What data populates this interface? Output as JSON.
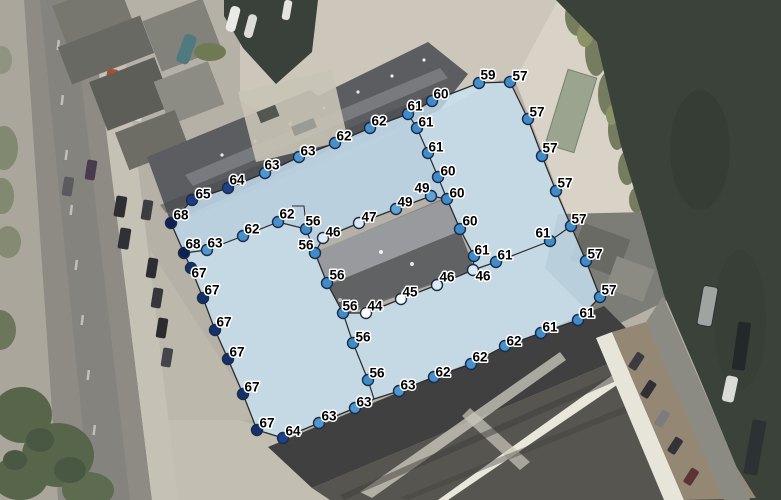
{
  "map_overlay": {
    "style": {
      "fill_color": "#c9e4f5",
      "fill_opacity": 0.8,
      "line_color": "#2b2b2e",
      "dot_radius": 5.5,
      "dot_stroke_color": "#1d2b45",
      "label_text_color": "#000000",
      "label_halo_color": "#ffffff"
    },
    "value_colors": {
      "44": "#ffffff",
      "45": "#f5fafd",
      "46": "#dbeaf6",
      "47": "#d8e8f5",
      "49": "#61a2d6",
      "56": "#3e8bca",
      "57": "#3e8bca",
      "59": "#4190cc",
      "60": "#3e8bca",
      "61": "#3f8ccb",
      "62": "#4690cc",
      "63": "#4e96cf",
      "64": "#1e4289",
      "65": "#1c3d7f",
      "67": "#15316c",
      "68": "#0d2157"
    },
    "outer_ring": [
      [
        171,
        223
      ],
      [
        192,
        200
      ],
      [
        228,
        188
      ],
      [
        265,
        173
      ],
      [
        299,
        157
      ],
      [
        335,
        143
      ],
      [
        370,
        128
      ],
      [
        408,
        114
      ],
      [
        432,
        101
      ],
      [
        479,
        83
      ],
      [
        510,
        82
      ],
      [
        528,
        119
      ],
      [
        542,
        156
      ],
      [
        556,
        191
      ],
      [
        571,
        226
      ],
      [
        586,
        261
      ],
      [
        600,
        297
      ],
      [
        578,
        320
      ],
      [
        541,
        333
      ],
      [
        505,
        346
      ],
      [
        471,
        364
      ],
      [
        434,
        377
      ],
      [
        399,
        391
      ],
      [
        374,
        399
      ],
      [
        355,
        408
      ],
      [
        319,
        423
      ],
      [
        283,
        438
      ],
      [
        257,
        430
      ],
      [
        243,
        394
      ],
      [
        228,
        359
      ],
      [
        215,
        330
      ],
      [
        203,
        298
      ],
      [
        191,
        268
      ],
      [
        184,
        253
      ]
    ],
    "inner_ring": [
      [
        315,
        253
      ],
      [
        323,
        238
      ],
      [
        359,
        223
      ],
      [
        396,
        209
      ],
      [
        431,
        196
      ],
      [
        447,
        199
      ],
      [
        460,
        229
      ],
      [
        474,
        256
      ],
      [
        473,
        270
      ],
      [
        437,
        285
      ],
      [
        401,
        299
      ],
      [
        366,
        313
      ],
      [
        343,
        313
      ],
      [
        327,
        283
      ]
    ],
    "interior_lines": [
      [
        [
          408,
          114
        ],
        [
          417,
          128
        ],
        [
          428,
          153
        ],
        [
          438,
          177
        ],
        [
          447,
          199
        ]
      ],
      [
        [
          473,
          270
        ],
        [
          496,
          262
        ],
        [
          550,
          241
        ],
        [
          571,
          226
        ]
      ],
      [
        [
          184,
          253
        ],
        [
          207,
          250
        ],
        [
          243,
          236
        ],
        [
          278,
          222
        ],
        [
          306,
          229
        ],
        [
          315,
          253
        ]
      ],
      [
        [
          343,
          313
        ],
        [
          353,
          343
        ],
        [
          368,
          380
        ],
        [
          374,
          399
        ]
      ]
    ],
    "label_leaders": [
      [
        [
          292,
          206
        ],
        [
          304,
          206
        ],
        [
          305,
          216
        ]
      ]
    ],
    "points": [
      {
        "x": 171,
        "y": 223,
        "v": "68",
        "lx": 10,
        "ly": -8
      },
      {
        "x": 192,
        "y": 200,
        "v": "65",
        "lx": 11,
        "ly": -6
      },
      {
        "x": 228,
        "y": 188,
        "v": "64",
        "lx": 9,
        "ly": -8
      },
      {
        "x": 265,
        "y": 173,
        "v": "63",
        "lx": 7,
        "ly": -8
      },
      {
        "x": 299,
        "y": 157,
        "v": "63",
        "lx": 9,
        "ly": -6
      },
      {
        "x": 335,
        "y": 143,
        "v": "62",
        "lx": 9,
        "ly": -7
      },
      {
        "x": 370,
        "y": 128,
        "v": "62",
        "lx": 9,
        "ly": -7
      },
      {
        "x": 408,
        "y": 114,
        "v": "61",
        "lx": 7,
        "ly": -8
      },
      {
        "x": 432,
        "y": 101,
        "v": "60",
        "lx": 9,
        "ly": -7
      },
      {
        "x": 479,
        "y": 83,
        "v": "59",
        "lx": 9,
        "ly": -8
      },
      {
        "x": 510,
        "y": 82,
        "v": "57",
        "lx": 10,
        "ly": -6
      },
      {
        "x": 528,
        "y": 119,
        "v": "57",
        "lx": 9,
        "ly": -7
      },
      {
        "x": 542,
        "y": 156,
        "v": "57",
        "lx": 8,
        "ly": -8
      },
      {
        "x": 556,
        "y": 191,
        "v": "57",
        "lx": 9,
        "ly": -8
      },
      {
        "x": 571,
        "y": 226,
        "v": "57",
        "lx": 8,
        "ly": -7
      },
      {
        "x": 586,
        "y": 261,
        "v": "57",
        "lx": 9,
        "ly": -7
      },
      {
        "x": 600,
        "y": 297,
        "v": "57",
        "lx": 9,
        "ly": -7
      },
      {
        "x": 578,
        "y": 320,
        "v": "61",
        "lx": 9,
        "ly": -7
      },
      {
        "x": 541,
        "y": 333,
        "v": "61",
        "lx": 9,
        "ly": -6
      },
      {
        "x": 505,
        "y": 346,
        "v": "62",
        "lx": 9,
        "ly": -5
      },
      {
        "x": 471,
        "y": 364,
        "v": "62",
        "lx": 9,
        "ly": -7
      },
      {
        "x": 434,
        "y": 377,
        "v": "62",
        "lx": 9,
        "ly": -5
      },
      {
        "x": 399,
        "y": 391,
        "v": "63",
        "lx": 9,
        "ly": -6
      },
      {
        "x": 355,
        "y": 408,
        "v": "63",
        "lx": 9,
        "ly": -6
      },
      {
        "x": 319,
        "y": 423,
        "v": "63",
        "lx": 10,
        "ly": -7
      },
      {
        "x": 283,
        "y": 438,
        "v": "64",
        "lx": 10,
        "ly": -7
      },
      {
        "x": 257,
        "y": 430,
        "v": "67",
        "lx": 10,
        "ly": -7
      },
      {
        "x": 243,
        "y": 394,
        "v": "67",
        "lx": 9,
        "ly": -7
      },
      {
        "x": 228,
        "y": 359,
        "v": "67",
        "lx": 9,
        "ly": -7
      },
      {
        "x": 215,
        "y": 330,
        "v": "67",
        "lx": 9,
        "ly": -8
      },
      {
        "x": 203,
        "y": 298,
        "v": "67",
        "lx": 9,
        "ly": -8
      },
      {
        "x": 191,
        "y": 268,
        "v": "67",
        "lx": 8,
        "ly": 5
      },
      {
        "x": 184,
        "y": 253,
        "v": "68",
        "lx": 9,
        "ly": -9
      },
      {
        "x": 315,
        "y": 253,
        "v": "56",
        "lx": -9,
        "ly": -8
      },
      {
        "x": 323,
        "y": 238,
        "v": "46",
        "lx": 10,
        "ly": -6
      },
      {
        "x": 359,
        "y": 223,
        "v": "47",
        "lx": 10,
        "ly": -6
      },
      {
        "x": 396,
        "y": 209,
        "v": "49",
        "lx": 9,
        "ly": -7
      },
      {
        "x": 431,
        "y": 196,
        "v": "49",
        "lx": -9,
        "ly": -8
      },
      {
        "x": 447,
        "y": 199,
        "v": "60",
        "lx": 10,
        "ly": -6
      },
      {
        "x": 460,
        "y": 229,
        "v": "60",
        "lx": 10,
        "ly": -8
      },
      {
        "x": 474,
        "y": 256,
        "v": "61",
        "lx": 8,
        "ly": -6
      },
      {
        "x": 473,
        "y": 270,
        "v": "46",
        "lx": 10,
        "ly": 6
      },
      {
        "x": 437,
        "y": 285,
        "v": "46",
        "lx": 10,
        "ly": -8
      },
      {
        "x": 401,
        "y": 299,
        "v": "45",
        "lx": 9,
        "ly": -7
      },
      {
        "x": 366,
        "y": 313,
        "v": "44",
        "lx": 9,
        "ly": -7
      },
      {
        "x": 343,
        "y": 313,
        "v": "56",
        "lx": 7,
        "ly": -7
      },
      {
        "x": 327,
        "y": 283,
        "v": "56",
        "lx": 10,
        "ly": -8
      },
      {
        "x": 417,
        "y": 128,
        "v": "61",
        "lx": 9,
        "ly": -6
      },
      {
        "x": 428,
        "y": 153,
        "v": "61",
        "lx": 8,
        "ly": -6
      },
      {
        "x": 438,
        "y": 177,
        "v": "60",
        "lx": 10,
        "ly": -6
      },
      {
        "x": 496,
        "y": 262,
        "v": "61",
        "lx": 9,
        "ly": -7
      },
      {
        "x": 550,
        "y": 241,
        "v": "61",
        "lx": -7,
        "ly": -8
      },
      {
        "x": 207,
        "y": 250,
        "v": "63",
        "lx": 8,
        "ly": -7
      },
      {
        "x": 243,
        "y": 236,
        "v": "62",
        "lx": 9,
        "ly": -7
      },
      {
        "x": 278,
        "y": 222,
        "v": "62",
        "lx": 9,
        "ly": -8
      },
      {
        "x": 306,
        "y": 229,
        "v": "56",
        "lx": 7,
        "ly": -8
      },
      {
        "x": 353,
        "y": 343,
        "v": "56",
        "lx": 10,
        "ly": -6
      },
      {
        "x": 368,
        "y": 380,
        "v": "56",
        "lx": 9,
        "ly": -7
      }
    ]
  }
}
